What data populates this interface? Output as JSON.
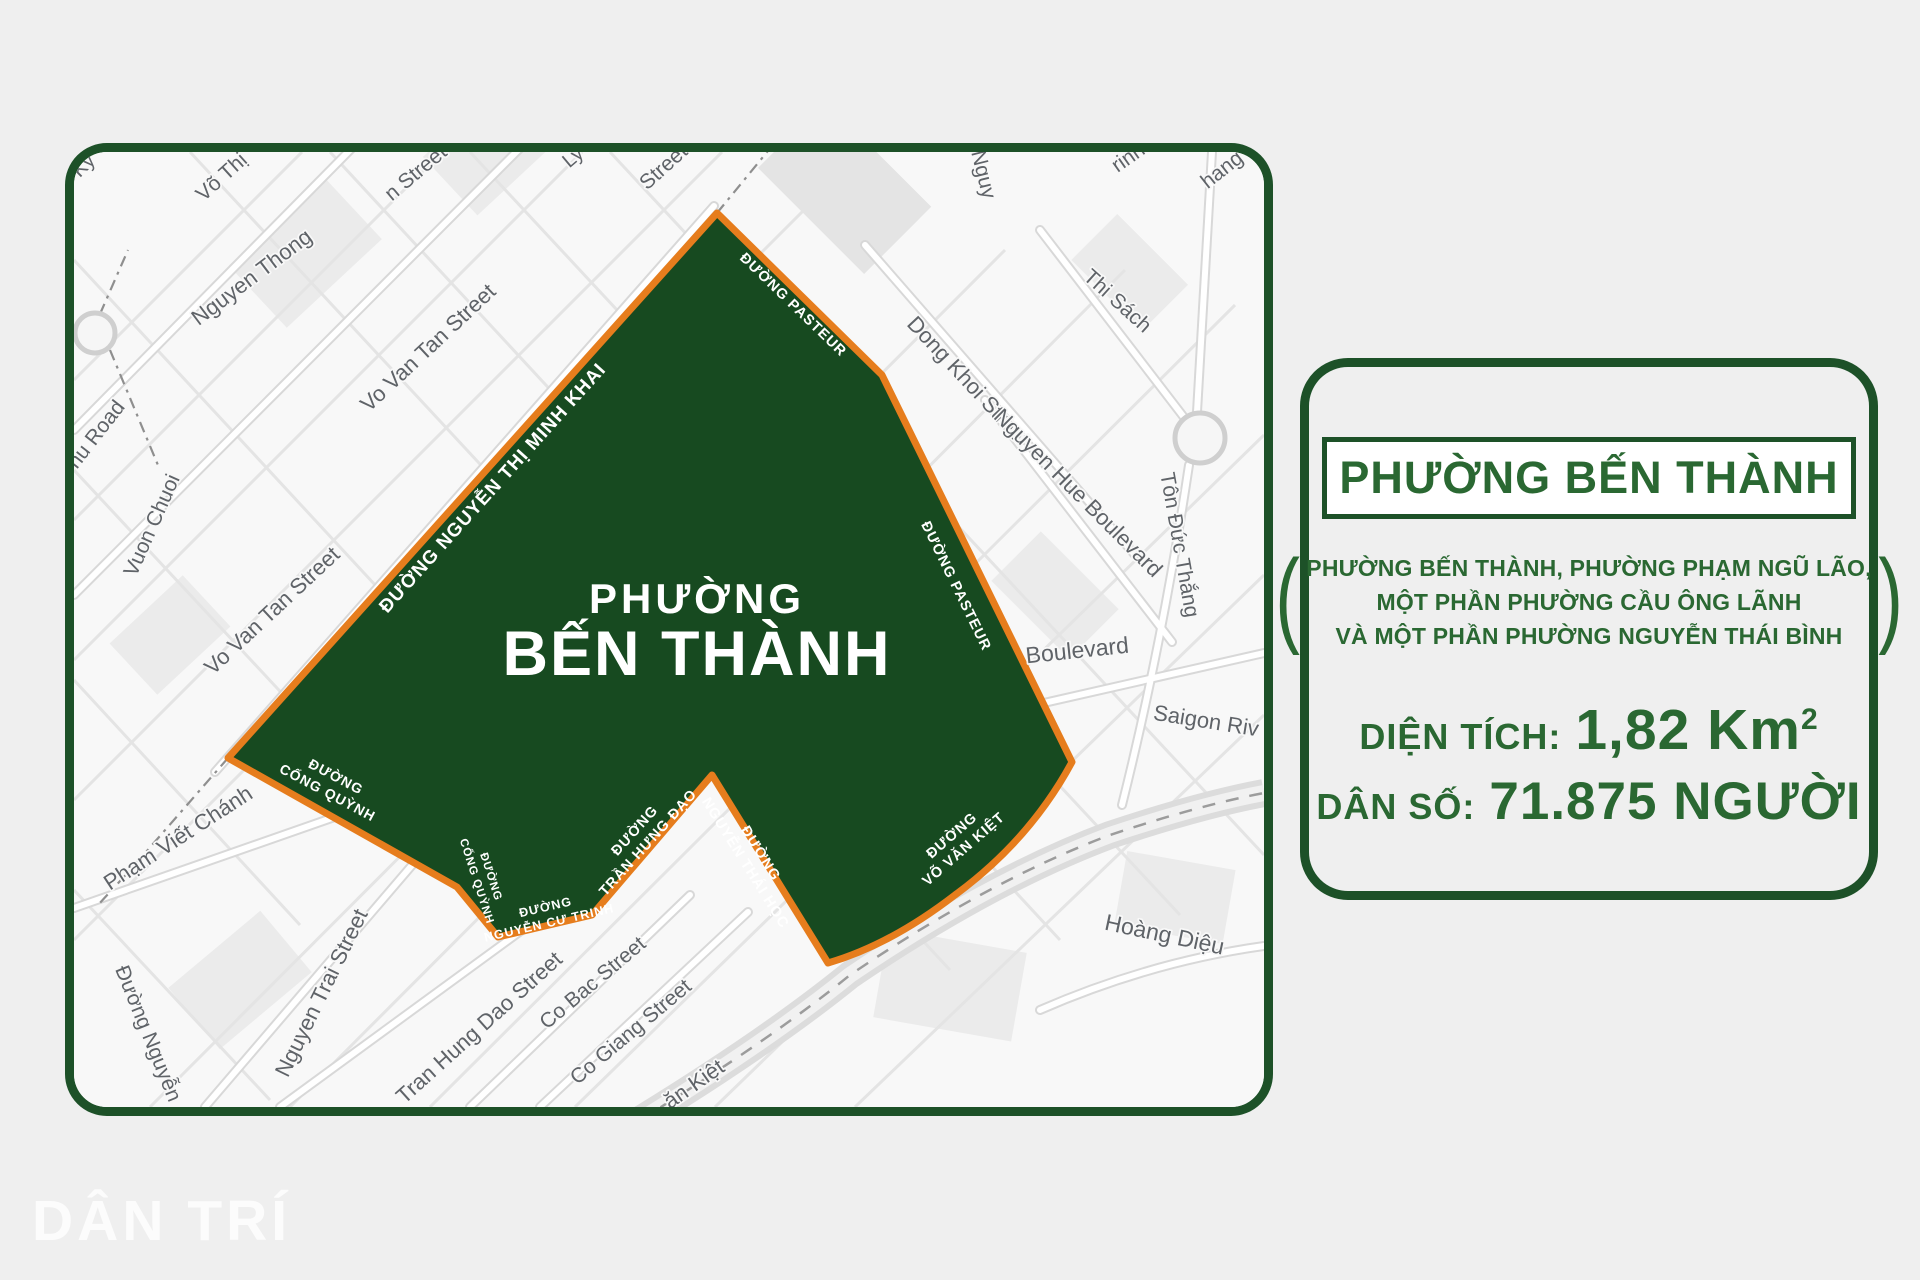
{
  "colors": {
    "page_background": "#efefef",
    "map_background": "#f8f8f8",
    "border_green": "#1d5128",
    "polygon_fill_green": "#174a20",
    "polygon_border_orange": "#e67d1d",
    "card_text_green": "#2a6832",
    "map_label_gray": "#5f6368"
  },
  "logo": {
    "text": "DÂN TRÍ"
  },
  "map": {
    "ward_label": {
      "line1": "PHƯỜNG",
      "line2": "BẾN THÀNH"
    },
    "edge_labels": [
      {
        "line1": "ĐƯỜNG NGUYỄN THỊ MINH KHAI"
      },
      {
        "line1": "ĐƯỜNG PASTEUR"
      },
      {
        "line1": "ĐƯỜNG PASTEUR"
      },
      {
        "line1": "ĐƯỜNG",
        "line2": "CỐNG QUỲNH"
      },
      {
        "line1": "ĐƯỜNG",
        "line2": "CỐNG QUỲNH"
      },
      {
        "line1": "ĐƯỜNG",
        "line2": "NGUYỄN CƯ TRINH"
      },
      {
        "line1": "ĐƯỜNG",
        "line2": "TRẦN HƯNG ĐẠO"
      },
      {
        "line1": "ĐƯỜNG",
        "line2": "NGUYỄN THÁI HỌC"
      },
      {
        "line1": "ĐƯỜNG",
        "line2": "VÕ VĂN KIỆT"
      }
    ],
    "street_labels": [
      {
        "text": "Kỳ"
      },
      {
        "text": "Võ Thị"
      },
      {
        "text": "n Street"
      },
      {
        "text": "Ly"
      },
      {
        "text": "Street"
      },
      {
        "text": "Nguy"
      },
      {
        "text": "rinh"
      },
      {
        "text": "hang"
      },
      {
        "text": "Nguyen Thong"
      },
      {
        "text": "Vo Van Tan Street"
      },
      {
        "text": "Phu Road"
      },
      {
        "text": "Vuon Chuoi"
      },
      {
        "text": "Vo Van Tan Street"
      },
      {
        "text": "Phạm Viết Chánh"
      },
      {
        "text": "Đường Nguyễn"
      },
      {
        "text": "Nguyen Trai Street"
      },
      {
        "text": "Tran Hung Dao Street"
      },
      {
        "text": "Co Bac Street"
      },
      {
        "text": "Co Giang Street"
      },
      {
        "text": "ăn Kiệt"
      },
      {
        "text": "Dong Khoi Street"
      },
      {
        "text": "Thi Sách"
      },
      {
        "text": "Nguyen Hue Boulevard"
      },
      {
        "text": "Tôn Đức Thắng"
      },
      {
        "text": "Boulevard"
      },
      {
        "text": "Saigon Riv"
      },
      {
        "text": "Hoàng Diệu"
      }
    ]
  },
  "info_card": {
    "title": "PHƯỜNG BẾN THÀNH",
    "paren_open": "(",
    "paren_close": ")",
    "note_lines": [
      "PHƯỜNG BẾN THÀNH, PHƯỜNG PHẠM NGŨ LÃO,",
      "MỘT PHẦN PHƯỜNG CẦU ÔNG LÃNH",
      "VÀ MỘT PHẦN PHƯỜNG NGUYỄN THÁI BÌNH"
    ],
    "area": {
      "label": "DIỆN TÍCH:",
      "value": "1,82 Km",
      "sup": "2"
    },
    "population": {
      "label": "DÂN SỐ:",
      "value": "71.875 NGƯỜI"
    }
  }
}
